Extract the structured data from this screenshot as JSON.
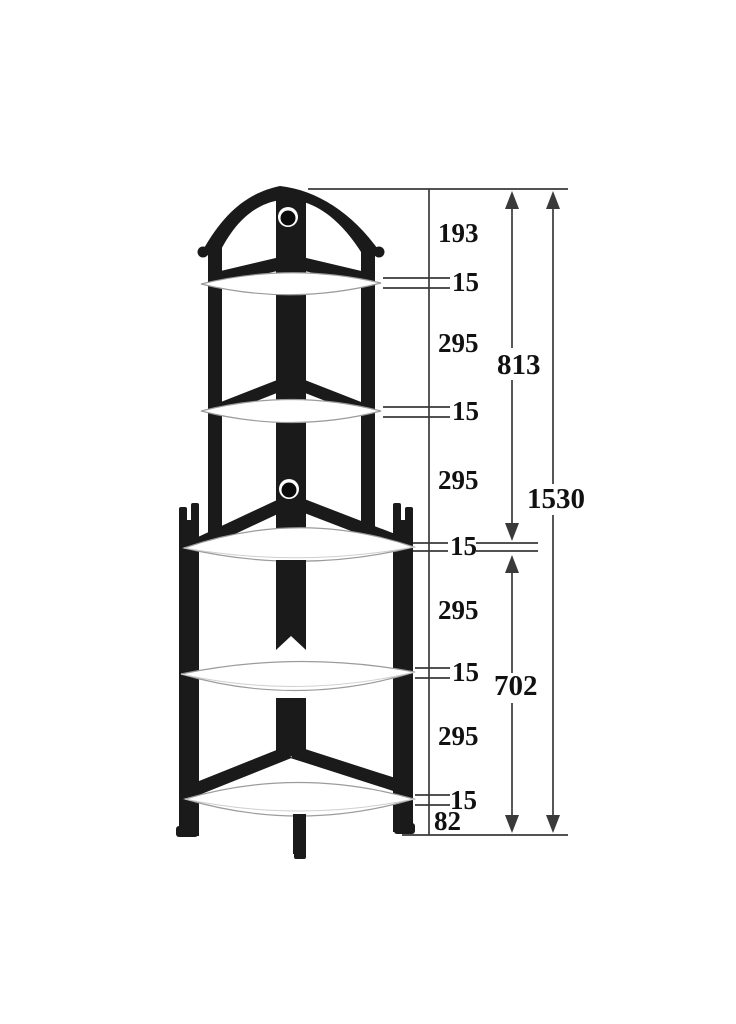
{
  "dims": {
    "chain": [
      "193",
      "15",
      "295",
      "15",
      "295",
      "15",
      "295",
      "15",
      "295",
      "15",
      "82"
    ],
    "upper": "813",
    "total": "1530",
    "lower": "702"
  },
  "figure": {
    "shelves": 5
  },
  "colors": {
    "ink": "#1a1a1a",
    "dimension_lines": "#3a3a3a",
    "background": "#ffffff",
    "shelf_edge": "#9b9b9b"
  }
}
